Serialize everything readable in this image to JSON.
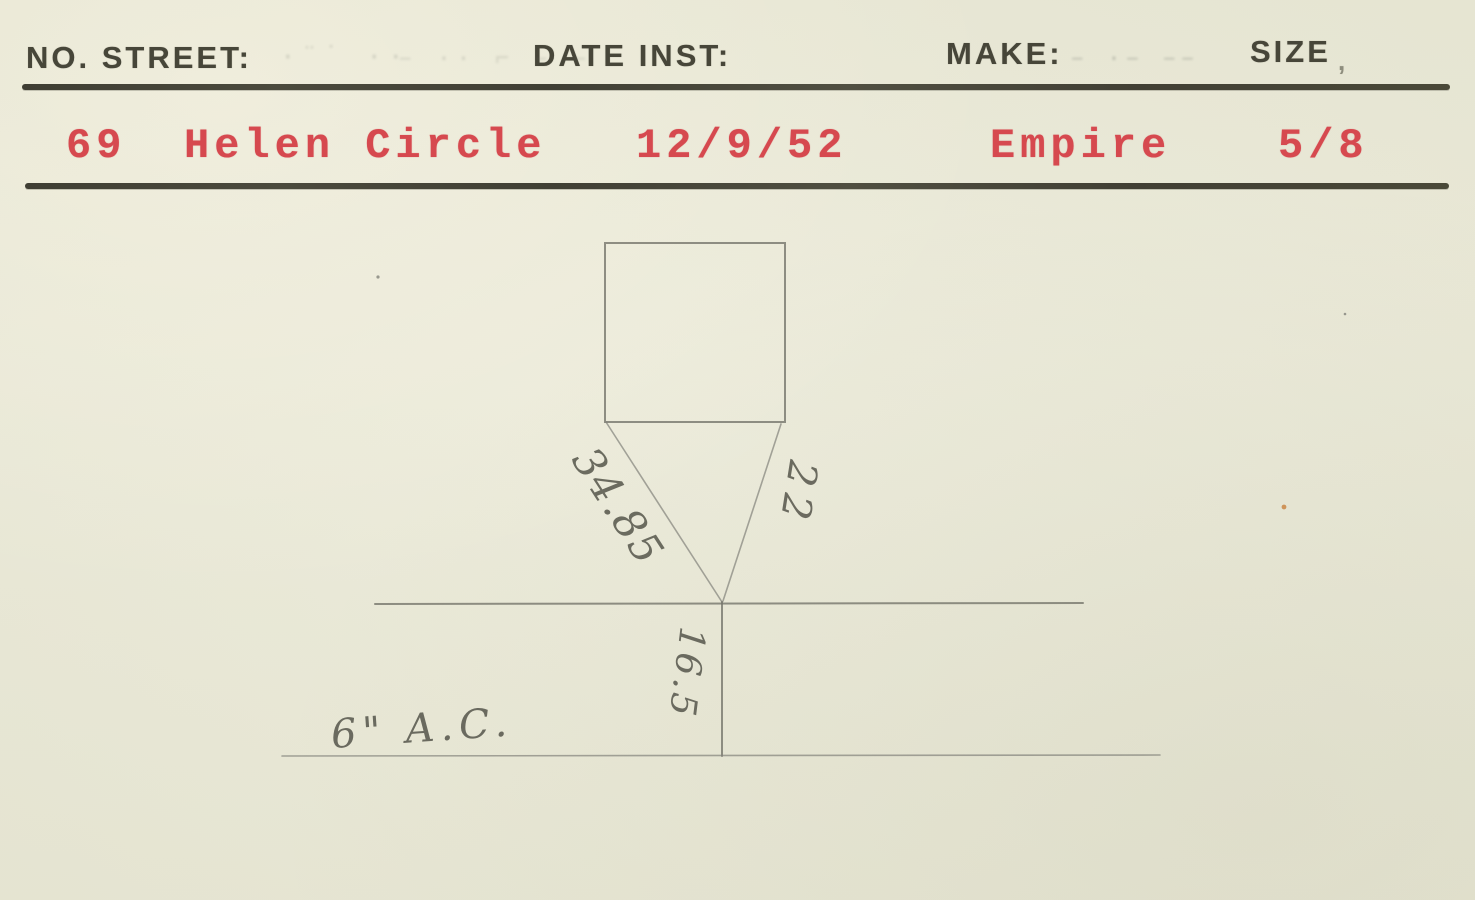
{
  "card": {
    "header": {
      "no_street_label": "NO. STREET:",
      "date_inst_label": "DATE INST:",
      "make_label": "MAKE:",
      "size_label": "SIZE",
      "size_comma": ",",
      "ghost_marks": {
        "after_street_a": "·¨˙ ··",
        "after_street_b": "– ·· ⌐ – –",
        "after_make": "– ·– ––"
      }
    },
    "record": {
      "number": "69",
      "street": "Helen Circle",
      "date_installed": "12/9/52",
      "make": "Empire",
      "size": "5/8"
    },
    "sketch": {
      "measurement_left_diagonal": "34.85",
      "measurement_right_diagonal": "22",
      "measurement_service_depth": "16.5",
      "main_pipe_label": "6\" A.C."
    },
    "colors": {
      "paper": "#e9e8d6",
      "printed_ink": "#474639",
      "typed_red": "#d6494f",
      "pencil": "#76766b"
    }
  }
}
